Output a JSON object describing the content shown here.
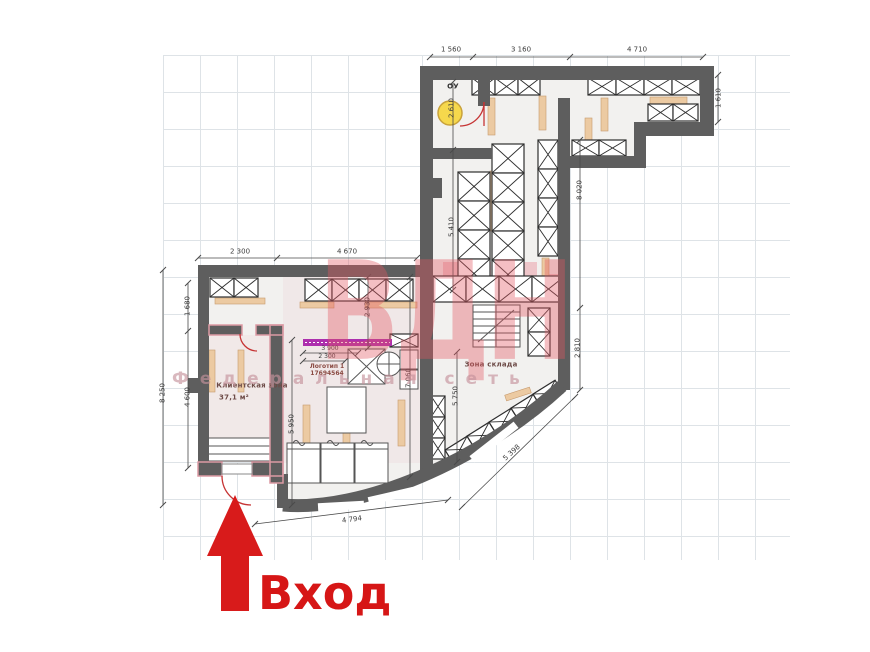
{
  "plan": {
    "rooms": {
      "client_zone": {
        "label": "Клиентская зона",
        "area": "37,1 м²"
      },
      "storage_zone": {
        "label": "Зона склада"
      },
      "ou_room": {
        "label": "ОУ"
      }
    },
    "note": {
      "line1": "Логотип 1",
      "line2": "17694564"
    },
    "dims": {
      "top_a": "1 560",
      "top_b": "3 160",
      "top_c": "4 710",
      "right_a": "1 610",
      "right_b": "8 020",
      "right_c": "2 810",
      "left_outer": "8 250",
      "left_inner_a": "1 680",
      "left_inner_b": "4 600",
      "lower_a": "2 300",
      "lower_b": "4 670",
      "v_ou": "2 610",
      "v_store": "5 410",
      "v_shop_a": "2 930",
      "v_shop_b": "5 950",
      "v_shop_c": "7 060",
      "v_store2": "5 750",
      "h_logo_a": "3 900",
      "h_logo_b": "2 300",
      "curve_a": "4 794",
      "curve_b": "5 398"
    }
  },
  "watermark": {
    "logo": "ВДН",
    "tagline": "Федеральная сеть"
  },
  "entrance": {
    "label": "Вход"
  },
  "colors": {
    "wall": "#5e5e5e",
    "entrance_red": "#d81b1b",
    "watermark_pink": "#e55a62",
    "magenta": "#ad2fad",
    "tan": "#eccaa2",
    "lamp_yellow": "#f6d84c",
    "grid": "#dee3e7",
    "pink_wall": "#dc9aa4"
  }
}
